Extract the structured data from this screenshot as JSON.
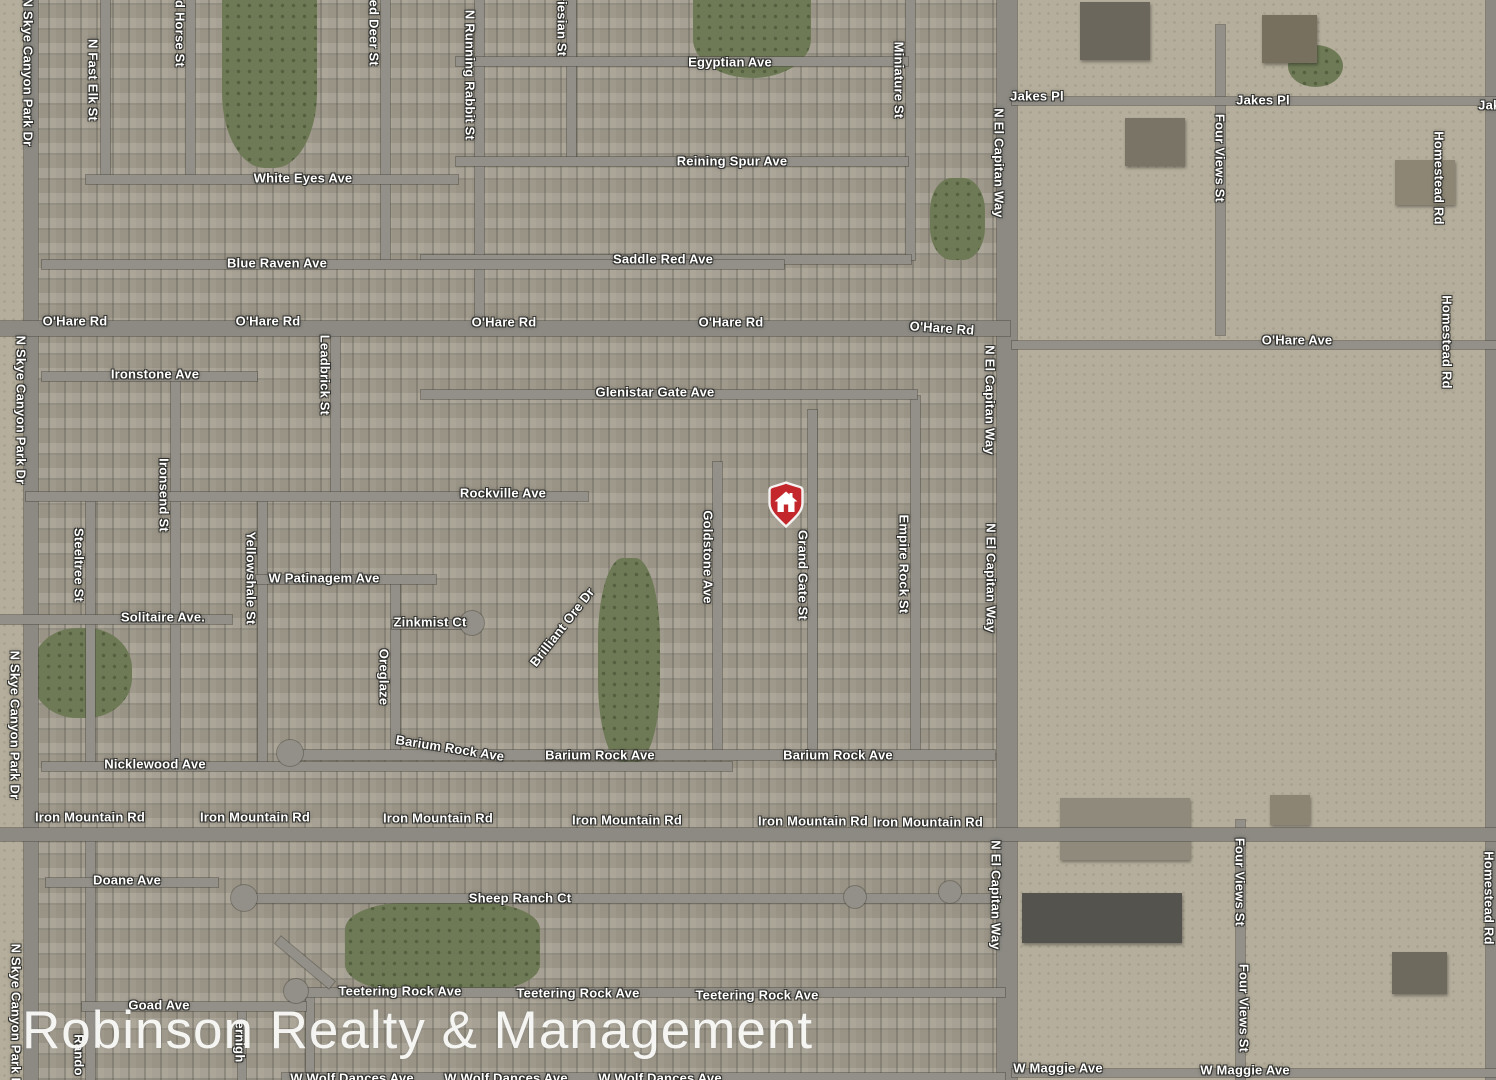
{
  "map": {
    "type": "satellite-map",
    "watermark": "Robinson Realty & Management",
    "marker": {
      "x": 786,
      "y": 528,
      "meaning": "property location pin"
    },
    "colors": {
      "residential": "#a19b8d",
      "desert": "#b5ae9c",
      "park": "#6e7a55",
      "road": "#939089",
      "label_text": "#ffffff",
      "marker_red": "#c3272b",
      "watermark_text": "#f9f9f7"
    },
    "street_labels": [
      {
        "t": "Egyptian Ave",
        "x": 730,
        "y": 62,
        "r": 0
      },
      {
        "t": "Reining Spur Ave",
        "x": 732,
        "y": 161,
        "r": 0
      },
      {
        "t": "White Eyes Ave",
        "x": 303,
        "y": 178,
        "r": 0
      },
      {
        "t": "Blue Raven Ave",
        "x": 277,
        "y": 263,
        "r": 0
      },
      {
        "t": "Saddle Red Ave",
        "x": 663,
        "y": 259,
        "r": 0
      },
      {
        "t": "O'Hare Rd",
        "x": 75,
        "y": 321,
        "r": 0
      },
      {
        "t": "O'Hare Rd",
        "x": 268,
        "y": 321,
        "r": 0
      },
      {
        "t": "O'Hare Rd",
        "x": 504,
        "y": 322,
        "r": 0
      },
      {
        "t": "O'Hare Rd",
        "x": 731,
        "y": 322,
        "r": 0
      },
      {
        "t": "O'Hare Rd",
        "x": 942,
        "y": 328,
        "r": 4
      },
      {
        "t": "O'Hare Ave",
        "x": 1297,
        "y": 340,
        "r": 0
      },
      {
        "t": "Jakes Pl",
        "x": 1037,
        "y": 96,
        "r": 0
      },
      {
        "t": "Jakes Pl",
        "x": 1263,
        "y": 100,
        "r": 0
      },
      {
        "t": "Jake",
        "x": 1493,
        "y": 105,
        "r": 0
      },
      {
        "t": "Ironstone Ave",
        "x": 155,
        "y": 374,
        "r": 0
      },
      {
        "t": "Glenistar Gate Ave",
        "x": 655,
        "y": 392,
        "r": 0
      },
      {
        "t": "Rockville Ave",
        "x": 503,
        "y": 493,
        "r": 0
      },
      {
        "t": "W Patinagem Ave",
        "x": 324,
        "y": 578,
        "r": 0
      },
      {
        "t": "Solitaire Ave.",
        "x": 163,
        "y": 617,
        "r": 0
      },
      {
        "t": "Zinkmist Ct",
        "x": 430,
        "y": 622,
        "r": 0
      },
      {
        "t": "Nicklewood Ave",
        "x": 155,
        "y": 764,
        "r": 0
      },
      {
        "t": "Barium Rock Ave",
        "x": 450,
        "y": 748,
        "r": 9
      },
      {
        "t": "Barium Rock Ave",
        "x": 600,
        "y": 755,
        "r": 0
      },
      {
        "t": "Barium Rock Ave",
        "x": 838,
        "y": 755,
        "r": 0
      },
      {
        "t": "Iron Mountain Rd",
        "x": 90,
        "y": 817,
        "r": 0
      },
      {
        "t": "Iron Mountain Rd",
        "x": 255,
        "y": 817,
        "r": 0
      },
      {
        "t": "Iron Mountain Rd",
        "x": 438,
        "y": 818,
        "r": 0
      },
      {
        "t": "Iron Mountain Rd",
        "x": 627,
        "y": 820,
        "r": 0
      },
      {
        "t": "Iron Mountain Rd",
        "x": 813,
        "y": 821,
        "r": 0
      },
      {
        "t": "Iron Mountain Rd",
        "x": 928,
        "y": 822,
        "r": 0
      },
      {
        "t": "Doane Ave",
        "x": 127,
        "y": 880,
        "r": 0
      },
      {
        "t": "Sheep Ranch Ct",
        "x": 520,
        "y": 898,
        "r": 0
      },
      {
        "t": "Goad Ave",
        "x": 159,
        "y": 1005,
        "r": 0
      },
      {
        "t": "Teetering Rock Ave",
        "x": 400,
        "y": 991,
        "r": 0
      },
      {
        "t": "Teetering Rock Ave",
        "x": 578,
        "y": 993,
        "r": 0
      },
      {
        "t": "Teetering Rock Ave",
        "x": 757,
        "y": 995,
        "r": 0
      },
      {
        "t": "W Maggie Ave",
        "x": 1058,
        "y": 1068,
        "r": 0
      },
      {
        "t": "W Maggie Ave",
        "x": 1245,
        "y": 1070,
        "r": 0
      },
      {
        "t": "W Wolf Dances Ave",
        "x": 352,
        "y": 1078,
        "r": 0
      },
      {
        "t": "W Wolf Dances Ave",
        "x": 506,
        "y": 1078,
        "r": 0
      },
      {
        "t": "W Wolf Dances Ave",
        "x": 660,
        "y": 1078,
        "r": 0
      },
      {
        "t": "N Skye Canyon Park Dr",
        "x": 28,
        "y": 72,
        "r": 90
      },
      {
        "t": "N Skye Canyon Park Dr",
        "x": 21,
        "y": 410,
        "r": 90
      },
      {
        "t": "N Skye Canyon Park Dr",
        "x": 15,
        "y": 725,
        "r": 90
      },
      {
        "t": "N Skye Canyon Park Dr",
        "x": 16,
        "y": 1018,
        "r": 90
      },
      {
        "t": "N Fast Elk St",
        "x": 93,
        "y": 80,
        "r": 90
      },
      {
        "t": "Red Horse St",
        "x": 180,
        "y": 25,
        "r": 90
      },
      {
        "t": "Red Deer St",
        "x": 374,
        "y": 28,
        "r": 90
      },
      {
        "t": "N Running Rabbit St",
        "x": 470,
        "y": 75,
        "r": 90
      },
      {
        "t": "Friesian St",
        "x": 562,
        "y": 22,
        "r": 90
      },
      {
        "t": "Miniature St",
        "x": 899,
        "y": 80,
        "r": 90
      },
      {
        "t": "N El Capitan Way",
        "x": 999,
        "y": 163,
        "r": 90
      },
      {
        "t": "N El Capitan Way",
        "x": 990,
        "y": 400,
        "r": 90
      },
      {
        "t": "N El Capitan Way",
        "x": 991,
        "y": 578,
        "r": 90
      },
      {
        "t": "N El Capitan Way",
        "x": 996,
        "y": 895,
        "r": 90
      },
      {
        "t": "Four Views St",
        "x": 1220,
        "y": 158,
        "r": 90
      },
      {
        "t": "Four Views St",
        "x": 1240,
        "y": 882,
        "r": 90
      },
      {
        "t": "Four Views St",
        "x": 1244,
        "y": 1008,
        "r": 90
      },
      {
        "t": "Homestead Rd",
        "x": 1439,
        "y": 178,
        "r": 90
      },
      {
        "t": "Homestead Rd",
        "x": 1447,
        "y": 342,
        "r": 90
      },
      {
        "t": "Homestead Rd",
        "x": 1489,
        "y": 898,
        "r": 90
      },
      {
        "t": "Leadbrick St",
        "x": 325,
        "y": 375,
        "r": 90
      },
      {
        "t": "Ironsend St",
        "x": 164,
        "y": 495,
        "r": 90
      },
      {
        "t": "Steeltree St",
        "x": 79,
        "y": 565,
        "r": 90
      },
      {
        "t": "Yellowshale St",
        "x": 251,
        "y": 578,
        "r": 90
      },
      {
        "t": "Oreglaze",
        "x": 384,
        "y": 677,
        "r": 90
      },
      {
        "t": "Brilliant Ore Dr",
        "x": 562,
        "y": 627,
        "r": -52
      },
      {
        "t": "Goldstone Ave",
        "x": 708,
        "y": 557,
        "r": 90
      },
      {
        "t": "Grand Gate St",
        "x": 803,
        "y": 575,
        "r": 90
      },
      {
        "t": "Empire Rock St",
        "x": 904,
        "y": 564,
        "r": 90
      },
      {
        "t": "Rando",
        "x": 79,
        "y": 1055,
        "r": 90
      },
      {
        "t": "ernigh",
        "x": 240,
        "y": 1042,
        "r": 90
      }
    ],
    "roads": [
      {
        "x": 24,
        "y": 0,
        "w": 14,
        "h": 1080,
        "major": true
      },
      {
        "x": 997,
        "y": 0,
        "w": 20,
        "h": 1080,
        "major": true
      },
      {
        "x": 1486,
        "y": 0,
        "w": 10,
        "h": 1080,
        "major": true
      },
      {
        "x": 1216,
        "y": 25,
        "w": 9,
        "h": 310
      },
      {
        "x": 1236,
        "y": 820,
        "w": 9,
        "h": 260
      },
      {
        "x": 906,
        "y": 0,
        "w": 9,
        "h": 260
      },
      {
        "x": 567,
        "y": 0,
        "w": 9,
        "h": 162
      },
      {
        "x": 475,
        "y": 0,
        "w": 9,
        "h": 330
      },
      {
        "x": 101,
        "y": 0,
        "w": 9,
        "h": 180
      },
      {
        "x": 186,
        "y": 0,
        "w": 9,
        "h": 180
      },
      {
        "x": 381,
        "y": 0,
        "w": 9,
        "h": 260
      },
      {
        "x": 331,
        "y": 333,
        "w": 9,
        "h": 247
      },
      {
        "x": 171,
        "y": 377,
        "w": 9,
        "h": 390
      },
      {
        "x": 86,
        "y": 497,
        "w": 9,
        "h": 270
      },
      {
        "x": 258,
        "y": 497,
        "w": 9,
        "h": 270
      },
      {
        "x": 391,
        "y": 580,
        "w": 9,
        "h": 173
      },
      {
        "x": 713,
        "y": 462,
        "w": 9,
        "h": 296
      },
      {
        "x": 808,
        "y": 410,
        "w": 9,
        "h": 348
      },
      {
        "x": 911,
        "y": 396,
        "w": 9,
        "h": 362
      },
      {
        "x": 86,
        "y": 833,
        "w": 9,
        "h": 247
      },
      {
        "x": 238,
        "y": 1005,
        "w": 8,
        "h": 75
      },
      {
        "x": 306,
        "y": 993,
        "w": 8,
        "h": 87
      },
      {
        "x": 456,
        "y": 57,
        "w": 452,
        "h": 9
      },
      {
        "x": 456,
        "y": 157,
        "w": 452,
        "h": 9
      },
      {
        "x": 421,
        "y": 255,
        "w": 490,
        "h": 9
      },
      {
        "x": 86,
        "y": 175,
        "w": 372,
        "h": 9
      },
      {
        "x": 42,
        "y": 260,
        "w": 742,
        "h": 9
      },
      {
        "x": 0,
        "y": 321,
        "w": 1010,
        "h": 15,
        "major": true
      },
      {
        "x": 1012,
        "y": 341,
        "w": 484,
        "h": 8
      },
      {
        "x": 1012,
        "y": 97,
        "w": 484,
        "h": 8
      },
      {
        "x": 42,
        "y": 372,
        "w": 215,
        "h": 9
      },
      {
        "x": 421,
        "y": 390,
        "w": 496,
        "h": 9
      },
      {
        "x": 26,
        "y": 492,
        "w": 562,
        "h": 9
      },
      {
        "x": 256,
        "y": 575,
        "w": 180,
        "h": 9
      },
      {
        "x": 392,
        "y": 620,
        "w": 82,
        "h": 9
      },
      {
        "x": 0,
        "y": 615,
        "w": 232,
        "h": 9
      },
      {
        "x": 42,
        "y": 762,
        "w": 690,
        "h": 9
      },
      {
        "x": 292,
        "y": 750,
        "w": 703,
        "h": 10
      },
      {
        "x": 0,
        "y": 828,
        "w": 1496,
        "h": 13,
        "major": true
      },
      {
        "x": 46,
        "y": 878,
        "w": 172,
        "h": 9
      },
      {
        "x": 242,
        "y": 894,
        "w": 748,
        "h": 9
      },
      {
        "x": 292,
        "y": 988,
        "w": 713,
        "h": 9
      },
      {
        "x": 270,
        "y": 958,
        "w": 70,
        "h": 9,
        "r": 40
      },
      {
        "x": 82,
        "y": 1002,
        "w": 224,
        "h": 9
      },
      {
        "x": 282,
        "y": 1073,
        "w": 723,
        "h": 7
      },
      {
        "x": 1012,
        "y": 1069,
        "w": 484,
        "h": 8
      }
    ],
    "road_bulbs": [
      {
        "x": 290,
        "y": 753,
        "rad": 13
      },
      {
        "x": 244,
        "y": 898,
        "rad": 13
      },
      {
        "x": 296,
        "y": 991,
        "rad": 12
      },
      {
        "x": 472,
        "y": 623,
        "rad": 12
      },
      {
        "x": 855,
        "y": 897,
        "rad": 11
      },
      {
        "x": 950,
        "y": 892,
        "rad": 11
      }
    ],
    "parks": [
      {
        "x": 222,
        "y": 0,
        "w": 95,
        "h": 168,
        "br": "0 0 45% 45%"
      },
      {
        "x": 693,
        "y": 0,
        "w": 118,
        "h": 78,
        "br": "0 0 50% 50%"
      },
      {
        "x": 930,
        "y": 178,
        "w": 55,
        "h": 82,
        "br": "40%"
      },
      {
        "x": 32,
        "y": 628,
        "w": 100,
        "h": 90,
        "br": "45%"
      },
      {
        "x": 345,
        "y": 903,
        "w": 195,
        "h": 88,
        "br": "30%"
      },
      {
        "x": 598,
        "y": 558,
        "w": 62,
        "h": 205,
        "br": "40%"
      },
      {
        "x": 1288,
        "y": 45,
        "w": 55,
        "h": 42,
        "br": "50%"
      }
    ],
    "desert_areas": [
      {
        "x": 0,
        "y": 0,
        "w": 24,
        "h": 1080
      },
      {
        "x": 1017,
        "y": 0,
        "w": 479,
        "h": 352
      },
      {
        "x": 1017,
        "y": 352,
        "w": 479,
        "h": 428
      },
      {
        "x": 1017,
        "y": 780,
        "w": 479,
        "h": 300
      }
    ],
    "structures": [
      {
        "x": 1080,
        "y": 2,
        "w": 70,
        "h": 58,
        "c": "#6b675c"
      },
      {
        "x": 1262,
        "y": 15,
        "w": 55,
        "h": 48,
        "c": "#77705f"
      },
      {
        "x": 1125,
        "y": 118,
        "w": 60,
        "h": 48,
        "c": "#7a7466"
      },
      {
        "x": 1395,
        "y": 160,
        "w": 60,
        "h": 45,
        "c": "#8d8674"
      },
      {
        "x": 1060,
        "y": 798,
        "w": 130,
        "h": 62,
        "c": "#8f8a7c"
      },
      {
        "x": 1022,
        "y": 893,
        "w": 160,
        "h": 50,
        "c": "#55534e"
      },
      {
        "x": 1270,
        "y": 795,
        "w": 40,
        "h": 30,
        "c": "#8d8573"
      },
      {
        "x": 1392,
        "y": 952,
        "w": 55,
        "h": 42,
        "c": "#6e6a5e"
      }
    ]
  }
}
